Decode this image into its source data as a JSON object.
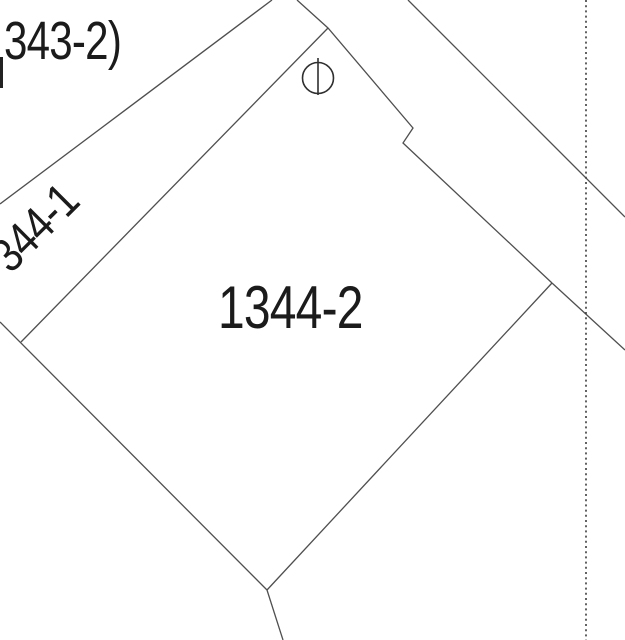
{
  "map": {
    "labels": {
      "adjacent_parcel": "343-2)",
      "strip_parcel": "344-1",
      "main_parcel": "1344-2"
    },
    "symbols": {
      "survey_marker": "circle-with-vertical-bar"
    },
    "colors": {
      "background": "#ffffff",
      "line": "#4f4f4f",
      "dotted_line": "#3c3c3c",
      "marker": "#2f2f2f",
      "text": "#1b1b1b"
    }
  }
}
